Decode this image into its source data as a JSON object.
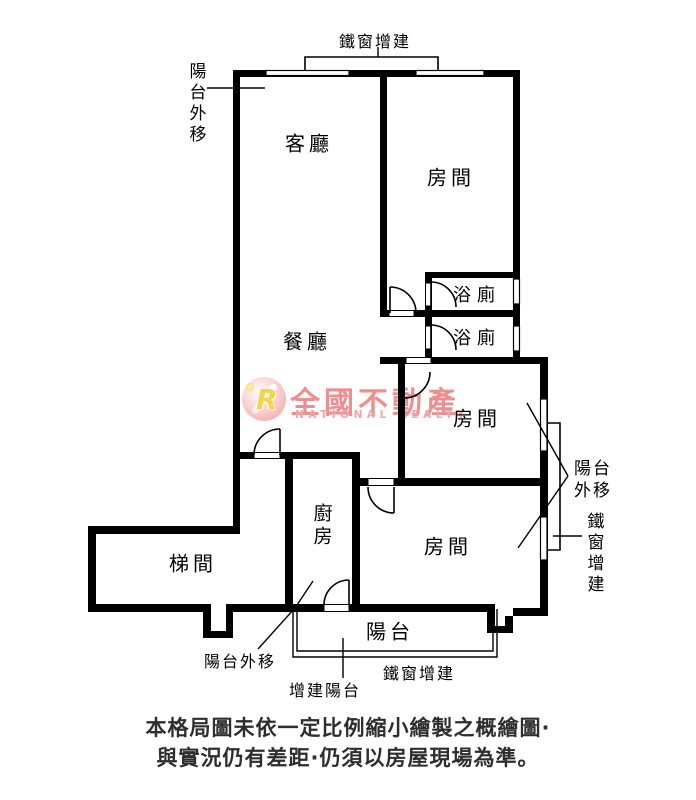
{
  "floor_plan": {
    "rooms": {
      "living": "客廳",
      "dining": "餐廳",
      "room": "房間",
      "bath": "浴廁",
      "kitchen": "廚房",
      "stairs": "梯間",
      "balcony": "陽台"
    },
    "annotations": {
      "iron_window": "鐵窗增建",
      "balcony_moved": "陽台外移",
      "added_balcony": "增建陽台"
    },
    "watermark": {
      "brand": "全國不動產",
      "subtitle": "NATIONAL REALTY",
      "logo_letter": "R"
    },
    "disclaimer": {
      "line1": "本格局圖未依一定比例縮小繪製之概繪圖·",
      "line2": "與實況仍有差距·仍須以房屋現場為準。"
    },
    "colors": {
      "line": "#000000",
      "watermark_text": "#ee8f8f",
      "watermark_subtitle": "#f2a5a5",
      "logo_yellow": "#f6d34c"
    }
  }
}
